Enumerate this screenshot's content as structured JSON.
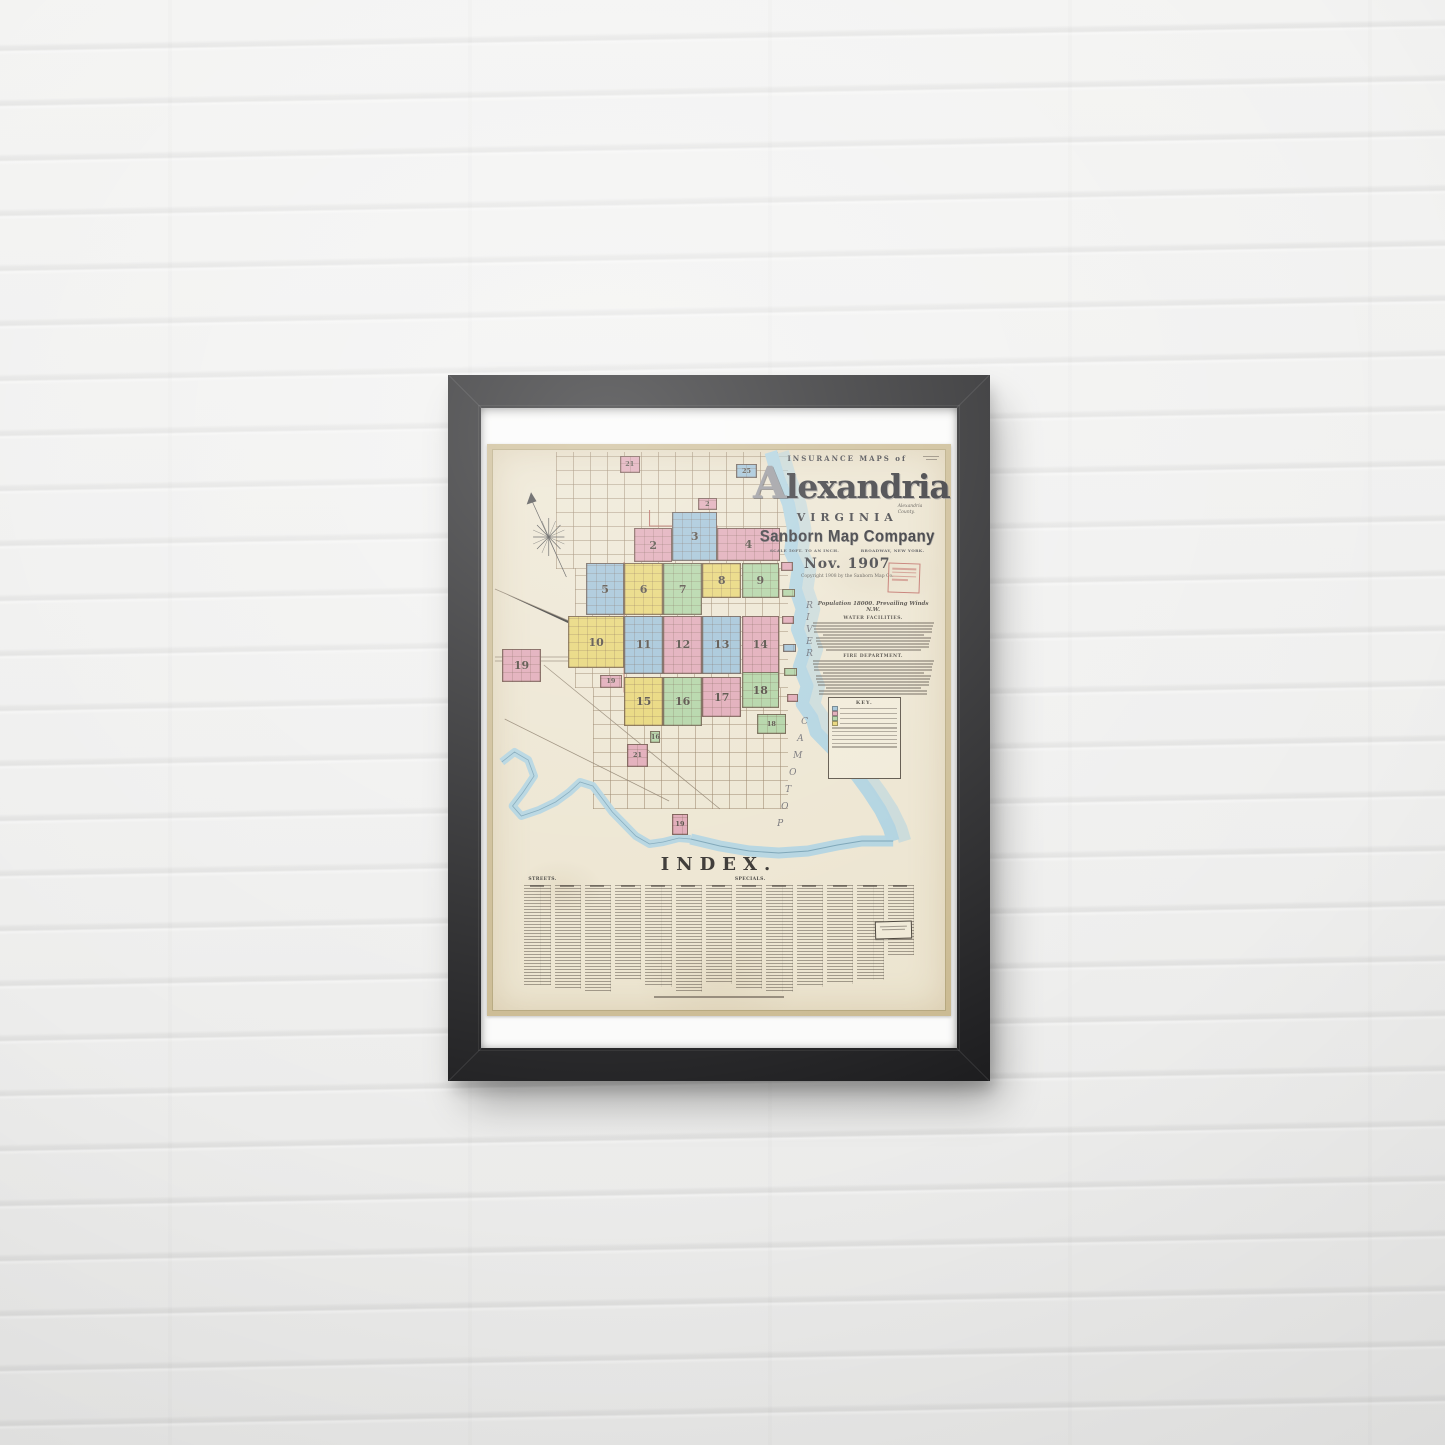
{
  "scene": {
    "description": "Framed Sanborn fire-insurance map poster hanging on a white painted brick wall",
    "frame_color": "#1b1b1d",
    "wall_color": "#efefee"
  },
  "poster": {
    "kicker": "INSURANCE MAPS of",
    "title": "Alexandria",
    "state": "VIRGINIA",
    "county_note": "Alexandria County.",
    "publisher": "Sanborn Map Company",
    "scale_note": "SCALE 50FT. TO AN INCH.",
    "address_note": "BROADWAY, NEW YORK.",
    "date": "Nov. 1907",
    "copyright": "Copyright 1908 by the Sanborn Map Co.",
    "population_line": "Population 18000. Prevailing Winds N.W.",
    "section_water": "WATER FACILITIES.",
    "section_fire": "FIRE DEPARTMENT.",
    "key_title": "KEY.",
    "index_title": "INDEX.",
    "index_col_streets": "STREETS.",
    "index_col_specials": "SPECIALS.",
    "river_label": "POTOMAC RIVER"
  },
  "map": {
    "colors": {
      "pink": "#dd9fae",
      "blue": "#96bcd3",
      "yellow": "#e5d166",
      "green": "#a8cf9a",
      "water": "#a9cfdd",
      "paper": "#ebe3cd",
      "boundary_red": "#a84a40"
    },
    "districts": [
      {
        "num": "21",
        "color": "pink",
        "x": 28.2,
        "y": 1.2,
        "w": 4.3,
        "h": 3.0
      },
      {
        "num": "25",
        "color": "blue",
        "x": 53.7,
        "y": 2.7,
        "w": 4.7,
        "h": 2.5
      },
      {
        "num": "2",
        "color": "pink",
        "x": 45.3,
        "y": 8.7,
        "w": 4.3,
        "h": 2.1
      },
      {
        "num": "3",
        "color": "blue",
        "x": 39.7,
        "y": 11.2,
        "w": 9.9,
        "h": 8.7
      },
      {
        "num": "2",
        "color": "pink",
        "x": 31.3,
        "y": 14.1,
        "w": 8.4,
        "h": 6.0
      },
      {
        "num": "4",
        "color": "pink",
        "x": 49.6,
        "y": 14.1,
        "w": 13.8,
        "h": 5.9
      },
      {
        "num": "5",
        "color": "blue",
        "x": 20.7,
        "y": 20.3,
        "w": 8.4,
        "h": 9.3
      },
      {
        "num": "6",
        "color": "yellow",
        "x": 29.1,
        "y": 20.3,
        "w": 8.6,
        "h": 9.3
      },
      {
        "num": "7",
        "color": "green",
        "x": 37.7,
        "y": 20.3,
        "w": 8.6,
        "h": 9.3
      },
      {
        "num": "8",
        "color": "yellow",
        "x": 46.3,
        "y": 20.3,
        "w": 8.6,
        "h": 6.2
      },
      {
        "num": "9",
        "color": "green",
        "x": 55.0,
        "y": 20.3,
        "w": 8.2,
        "h": 6.2
      },
      {
        "num": "10",
        "color": "yellow",
        "x": 16.8,
        "y": 29.7,
        "w": 12.3,
        "h": 9.3
      },
      {
        "num": "11",
        "color": "blue",
        "x": 29.1,
        "y": 29.7,
        "w": 8.6,
        "h": 10.3
      },
      {
        "num": "12",
        "color": "pink",
        "x": 37.7,
        "y": 29.7,
        "w": 8.6,
        "h": 10.3
      },
      {
        "num": "13",
        "color": "blue",
        "x": 46.3,
        "y": 29.7,
        "w": 8.6,
        "h": 10.3
      },
      {
        "num": "14",
        "color": "pink",
        "x": 55.0,
        "y": 29.7,
        "w": 8.2,
        "h": 10.3
      },
      {
        "num": "19",
        "color": "pink",
        "x": 2.2,
        "y": 35.6,
        "w": 8.6,
        "h": 5.9
      },
      {
        "num": "19",
        "color": "pink",
        "x": 23.7,
        "y": 40.2,
        "w": 5.0,
        "h": 2.3
      },
      {
        "num": "15",
        "color": "yellow",
        "x": 29.1,
        "y": 40.6,
        "w": 8.6,
        "h": 8.7
      },
      {
        "num": "16",
        "color": "green",
        "x": 37.7,
        "y": 40.6,
        "w": 8.6,
        "h": 8.7
      },
      {
        "num": "17",
        "color": "pink",
        "x": 46.3,
        "y": 40.6,
        "w": 8.6,
        "h": 7.1
      },
      {
        "num": "18",
        "color": "green",
        "x": 55.0,
        "y": 39.7,
        "w": 8.2,
        "h": 6.4
      },
      {
        "num": "18",
        "color": "green",
        "x": 58.4,
        "y": 47.2,
        "w": 6.3,
        "h": 3.6
      },
      {
        "num": "16",
        "color": "green",
        "x": 34.9,
        "y": 50.2,
        "w": 2.2,
        "h": 2.1
      },
      {
        "num": "21",
        "color": "pink",
        "x": 29.7,
        "y": 52.5,
        "w": 4.7,
        "h": 4.1
      },
      {
        "num": "19",
        "color": "pink",
        "x": 39.7,
        "y": 64.9,
        "w": 3.4,
        "h": 3.7
      }
    ],
    "wharves": [
      {
        "color": "pink",
        "x": 63.6,
        "y": 20.1,
        "w": 2.6,
        "h": 1.6
      },
      {
        "color": "green",
        "x": 63.8,
        "y": 24.9,
        "w": 3.0,
        "h": 1.4
      },
      {
        "color": "pink",
        "x": 63.8,
        "y": 29.7,
        "w": 2.8,
        "h": 1.4
      },
      {
        "color": "blue",
        "x": 64.0,
        "y": 34.7,
        "w": 3.0,
        "h": 1.4
      },
      {
        "color": "green",
        "x": 64.4,
        "y": 39.0,
        "w": 2.8,
        "h": 1.4
      },
      {
        "color": "pink",
        "x": 64.9,
        "y": 43.6,
        "w": 2.6,
        "h": 1.4
      }
    ],
    "river_letter_stacks": [
      {
        "word": "RIVER",
        "x": 69.2,
        "y": 27.0,
        "dx": 0,
        "dy": 12,
        "reverse": false
      },
      {
        "word": "POTOMAC",
        "x": 68.1,
        "y": 47.7,
        "dx": -4,
        "dy": 17,
        "reverse": true
      }
    ]
  }
}
